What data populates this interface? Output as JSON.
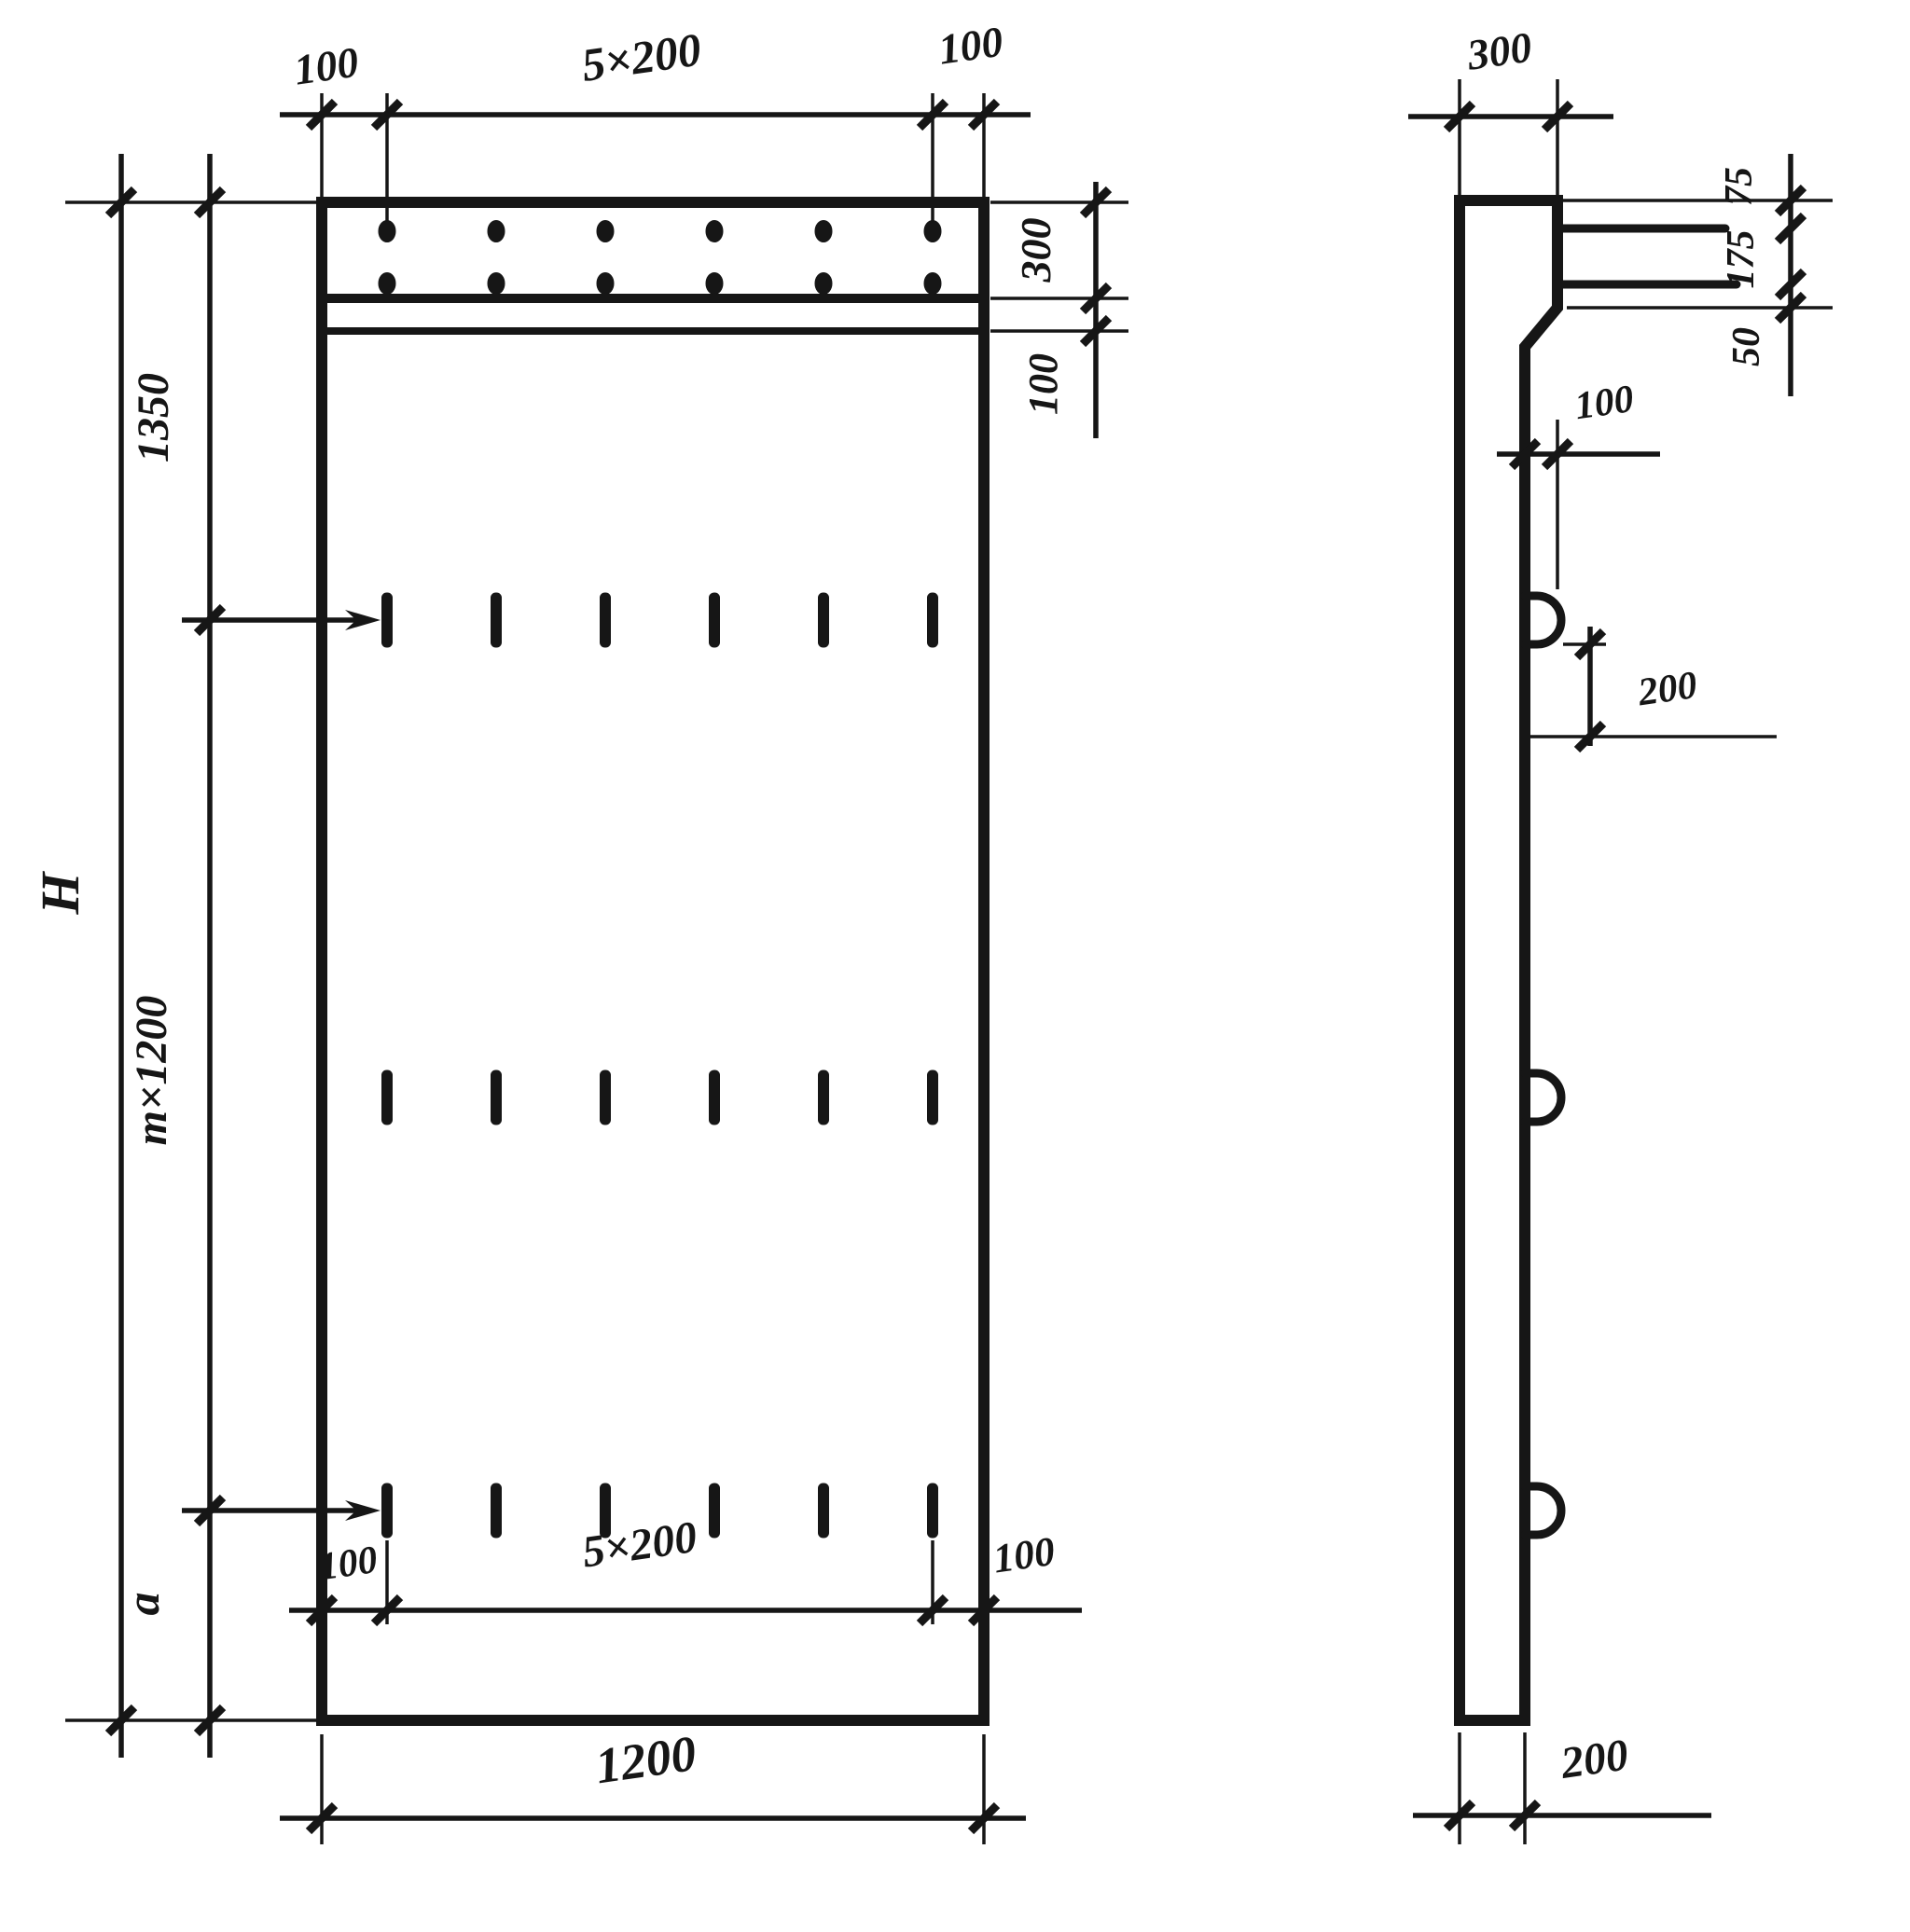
{
  "drawing": {
    "ink_color": "#161616",
    "background": "#ffffff",
    "labels": {
      "front": {
        "top_left_margin": "100",
        "top_spacing": "5×200",
        "top_right_margin": "100",
        "band_height": "300",
        "band_lip": "100",
        "height_total": "H",
        "height_top": "1350",
        "height_middle": "m×1200",
        "height_bottom": "a",
        "bottom_left_margin": "100",
        "bottom_spacing": "5×200",
        "bottom_right_margin": "100",
        "width": "1200"
      },
      "side": {
        "top_thickness": "300",
        "bar_offset_top": "75",
        "bar_spacing": "175",
        "bar_offset_bottom": "50",
        "loop_projection": "100",
        "loop_drop": "200",
        "wall_thickness": "200"
      }
    }
  }
}
